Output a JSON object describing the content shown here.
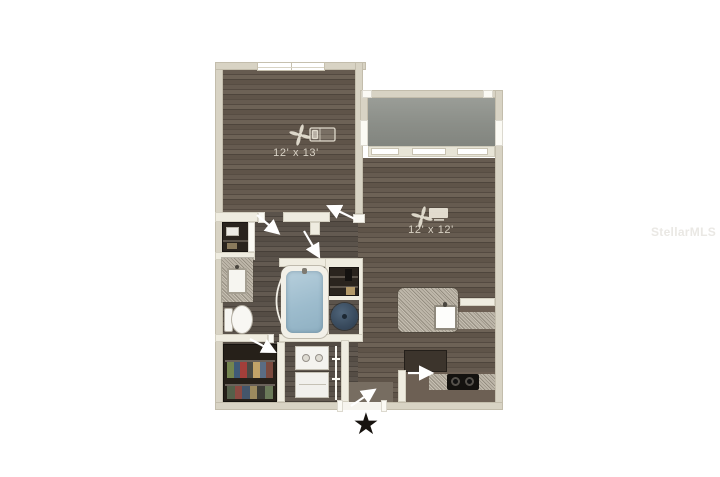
{
  "image": {
    "type": "floor-plan",
    "background": "#ffffff"
  },
  "watermark": {
    "text": "StellarMLS",
    "color": "#eae8e4"
  },
  "floorplan": {
    "rooms": [
      {
        "name": "bedroom",
        "dimensions": "12' x 13'",
        "icons": [
          "ceiling-fan",
          "bed"
        ],
        "floor": "wood"
      },
      {
        "name": "living-room",
        "dimensions": "12' x 12'",
        "icons": [
          "ceiling-fan",
          "tv"
        ],
        "floor": "wood"
      },
      {
        "name": "balcony",
        "floor": "concrete",
        "icons": [
          "sliding-door"
        ]
      },
      {
        "name": "bathroom",
        "icons": [
          "bathtub",
          "shower-curtain",
          "vanity-sink",
          "toilet",
          "water-heater"
        ]
      },
      {
        "name": "walk-in-closet",
        "icons": [
          "hanging-clothes"
        ]
      },
      {
        "name": "laundry",
        "icons": [
          "washer-dryer",
          "bifold-door"
        ]
      },
      {
        "name": "kitchen",
        "icons": [
          "island-sink",
          "breakfast-bar",
          "cooktop",
          "counter"
        ]
      }
    ],
    "entry_marker": "★",
    "colors": {
      "wall": "#d8d3c4",
      "wood_floor": "#5f554b",
      "balcony_floor": "#8f928c",
      "granite": "#b3aca0",
      "tub": "#a2c0d1",
      "cabinet_brown": "#6d6054",
      "star": "#17130f"
    }
  }
}
